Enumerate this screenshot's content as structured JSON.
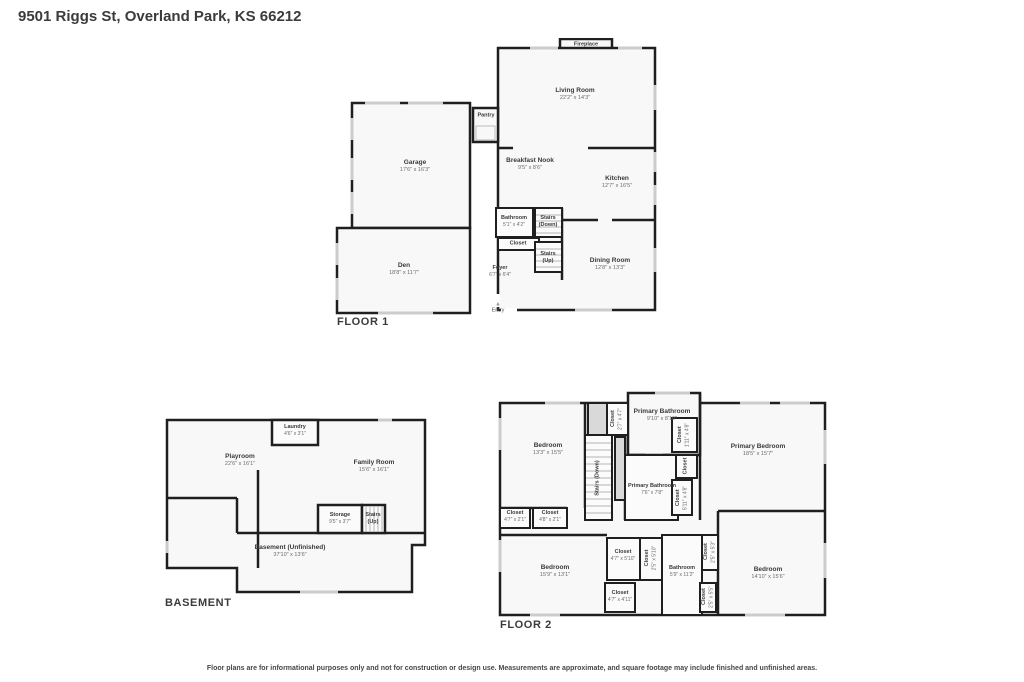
{
  "header": {
    "address": "9501 Riggs St, Overland Park, KS 66212"
  },
  "disclaimer": "Floor plans are for informational purposes only and not for construction or design use. Measurements are approximate, and square footage may include finished and unfinished areas.",
  "floor1": {
    "label": "FLOOR 1",
    "fireplace": {
      "name": "Fireplace"
    },
    "living_room": {
      "name": "Living Room",
      "dims": "22'2\" x 14'3\""
    },
    "garage": {
      "name": "Garage",
      "dims": "17'6\" x 16'3\""
    },
    "pantry": {
      "name": "Pantry"
    },
    "breakfast_nook": {
      "name": "Breakfast Nook",
      "dims": "9'5\" x 8'6\""
    },
    "kitchen": {
      "name": "Kitchen",
      "dims": "12'7\" x 16'5\""
    },
    "bathroom": {
      "name": "Bathroom",
      "dims": "5'1\" x 4'2\""
    },
    "stairs_down": {
      "name": "Stairs",
      "dir": "(Down)"
    },
    "closet": {
      "name": "Closet"
    },
    "stairs_up": {
      "name": "Stairs",
      "dir": "(Up)"
    },
    "dining_room": {
      "name": "Dining Room",
      "dims": "12'8\" x 13'3\""
    },
    "foyer": {
      "name": "Foyer",
      "dims": "6'7\" x 6'4\""
    },
    "den": {
      "name": "Den",
      "dims": "18'8\" x 11'7\""
    },
    "entry": {
      "name": "Entry"
    }
  },
  "basement": {
    "label": "BASEMENT",
    "laundry": {
      "name": "Laundry",
      "dims": "4'6\" x 3'1\""
    },
    "playroom": {
      "name": "Playroom",
      "dims": "22'6\" x 16'1\""
    },
    "family_room": {
      "name": "Family Room",
      "dims": "15'6\" x 16'1\""
    },
    "storage": {
      "name": "Storage",
      "dims": "9'5\" x 3'7\""
    },
    "stairs_up": {
      "name": "Stairs",
      "dir": "(Up)"
    },
    "unfinished": {
      "name": "Basement (Unfinished)",
      "dims": "37'10\" x 13'6\""
    }
  },
  "floor2": {
    "label": "FLOOR 2",
    "bedroom_tl": {
      "name": "Bedroom",
      "dims": "13'3\" x 15'5\""
    },
    "closet_stairs": {
      "name": "Closet",
      "dims": "2'7\" x 4'7\""
    },
    "stairs_down": {
      "name": "Stairs (Down)"
    },
    "primary_bathroom_top": {
      "name": "Primary Bathroom",
      "dims": "9'10\" x 8'10\""
    },
    "closet_pb1": {
      "name": "Closet",
      "dims": "1'11\" x 4'8\""
    },
    "primary_bedroom": {
      "name": "Primary Bedroom",
      "dims": "18'5\" x 15'7\""
    },
    "closet_mid": {
      "name": "Closet"
    },
    "primary_bathroom_mid": {
      "name": "Primary Bathroom",
      "dims": "7'6\" x 7'8\""
    },
    "closet_pb2": {
      "name": "Closet",
      "dims": "5'11\" x 4'8\""
    },
    "closet_hall1": {
      "name": "Closet",
      "dims": "4'7\" x 2'1\""
    },
    "closet_hall2": {
      "name": "Closet",
      "dims": "4'8\" x 2'1\""
    },
    "bedroom_bl": {
      "name": "Bedroom",
      "dims": "15'9\" x 13'1\""
    },
    "closet_b1": {
      "name": "Closet",
      "dims": "4'7\" x 5'10\""
    },
    "closet_b2": {
      "name": "Closet",
      "dims": "2'5\" x 5'10\""
    },
    "bathroom": {
      "name": "Bathroom",
      "dims": "5'9\" x 11'2\""
    },
    "closet_b3": {
      "name": "Closet",
      "dims": "2'5\" x 5'3\""
    },
    "closet_b4": {
      "name": "Closet",
      "dims": "2'5\" x 5'5\""
    },
    "closet_b5": {
      "name": "Closet",
      "dims": "4'7\" x 4'11\""
    },
    "bedroom_br": {
      "name": "Bedroom",
      "dims": "14'10\" x 15'6\""
    }
  }
}
